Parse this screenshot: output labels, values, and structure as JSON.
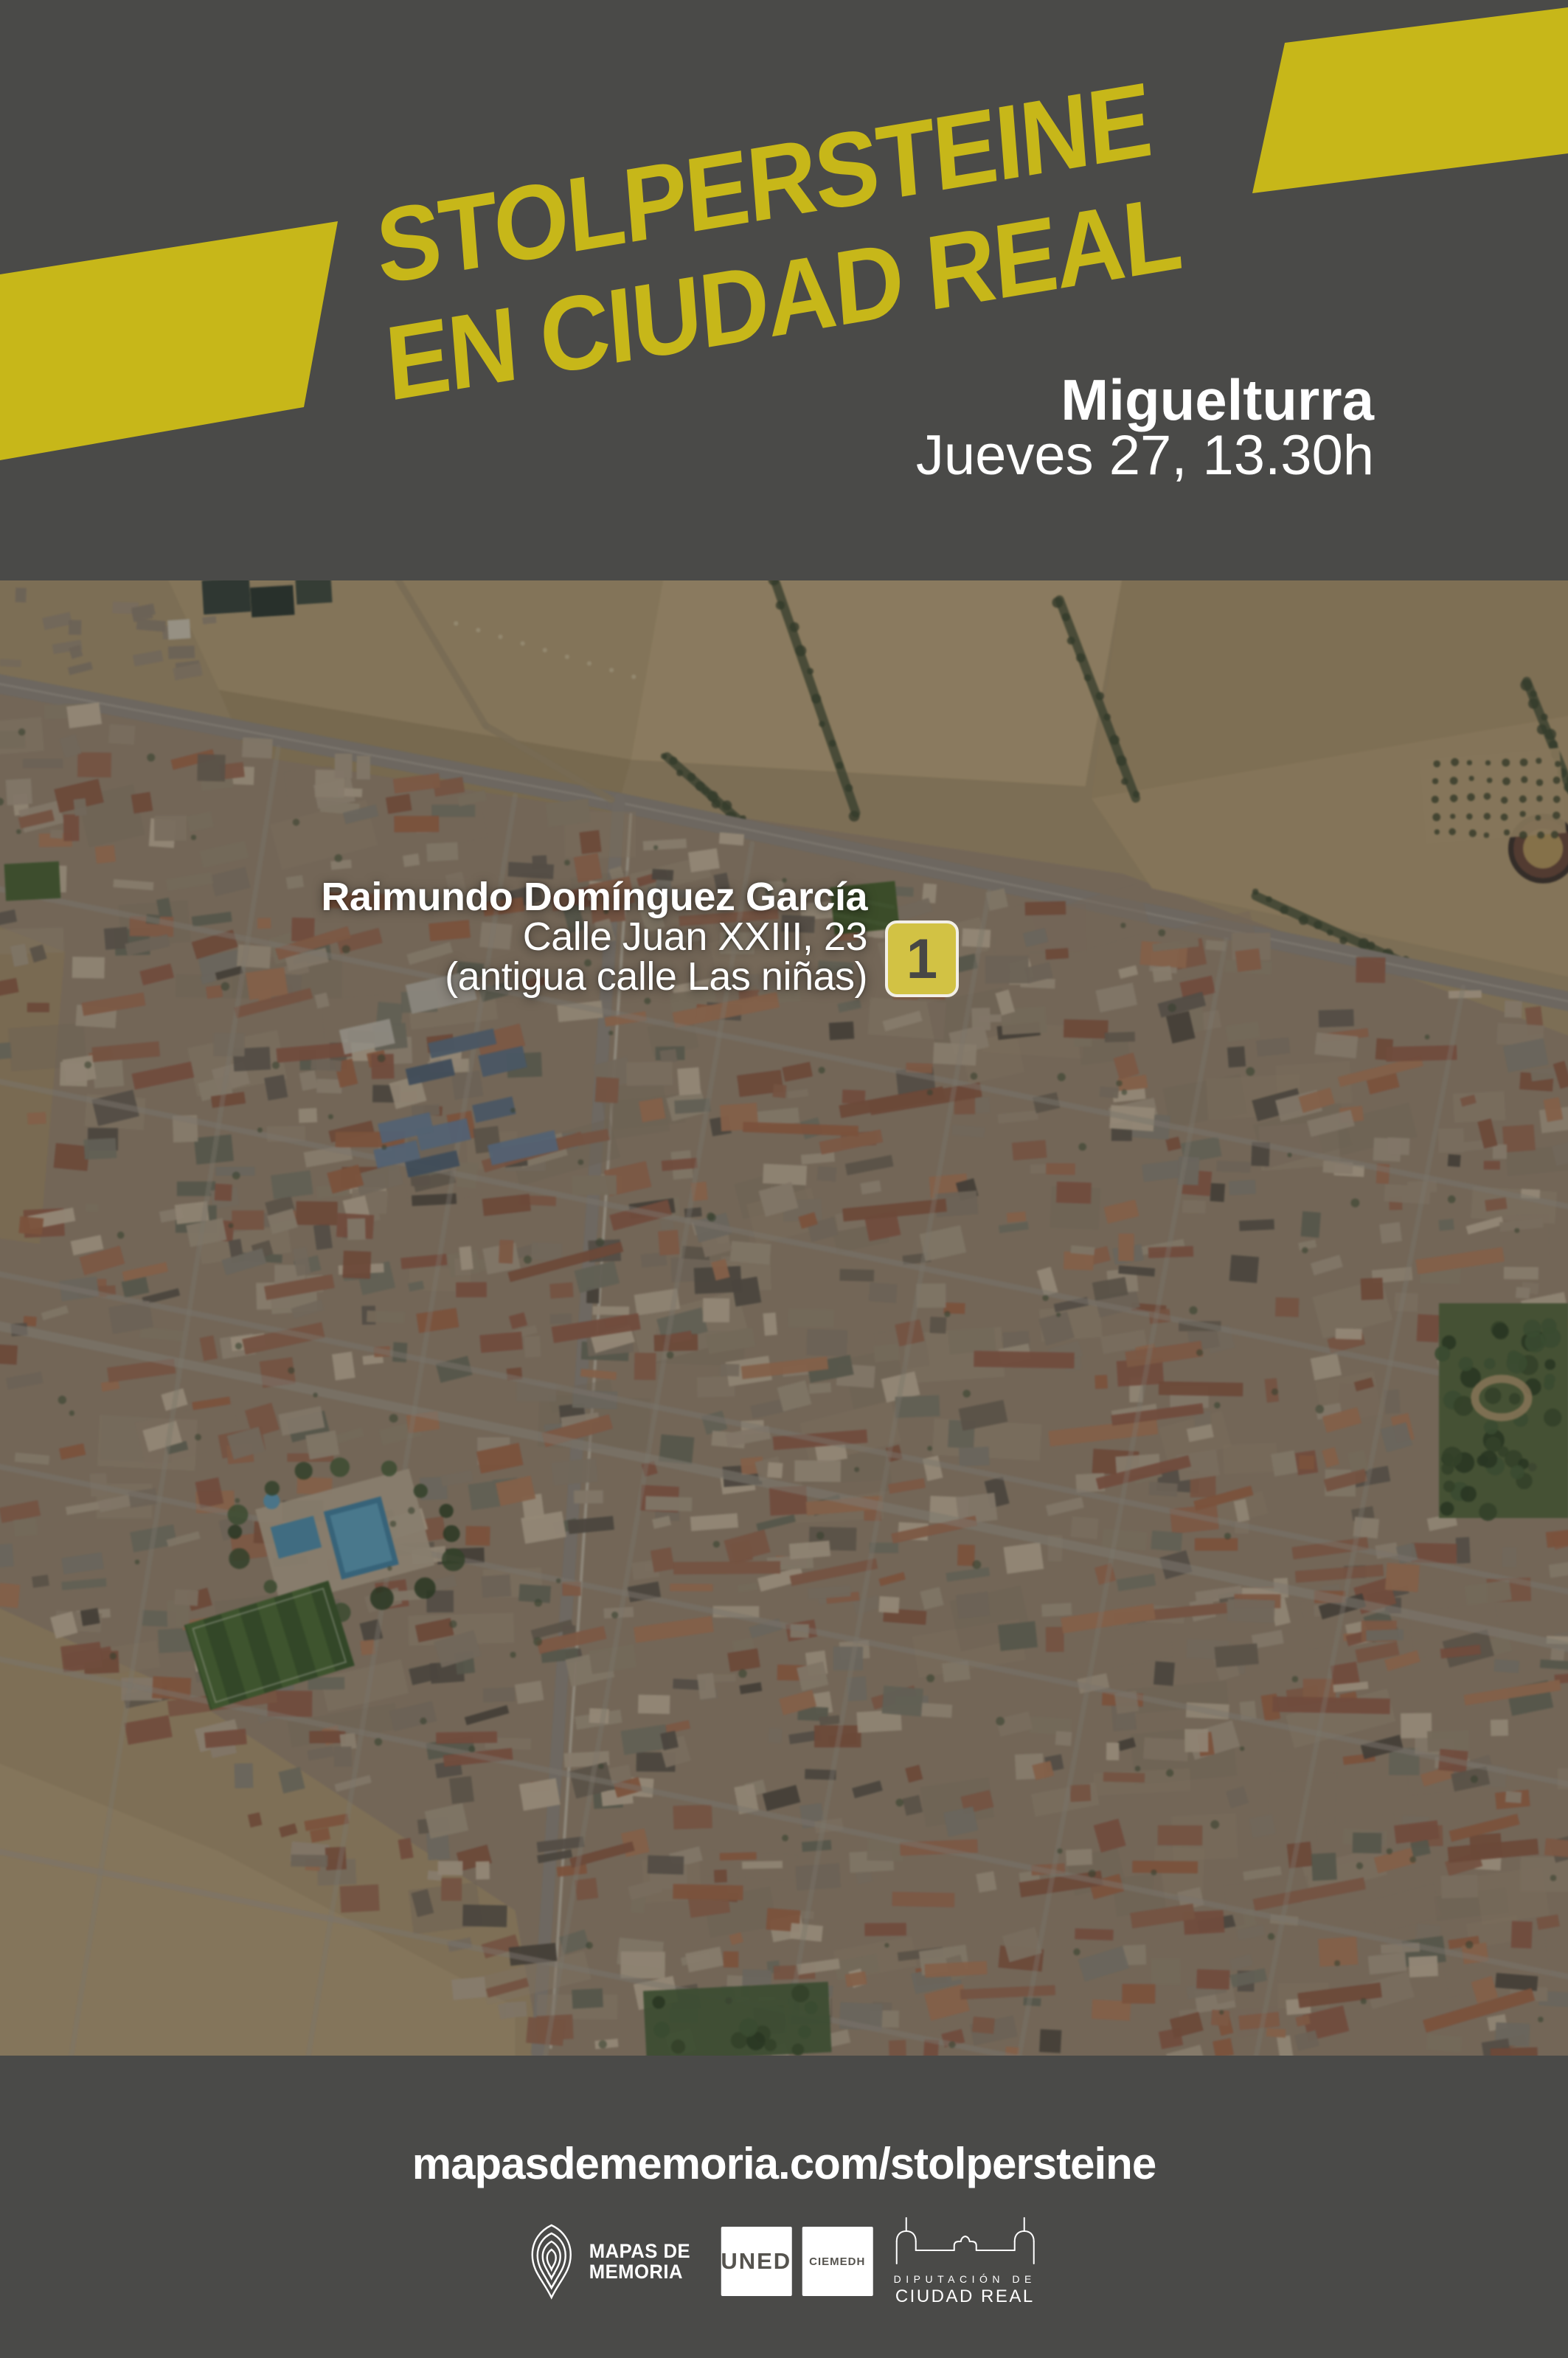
{
  "poster": {
    "title": {
      "line1": "STOLPERSTEINE",
      "line2": "EN CIUDAD REAL"
    },
    "event": {
      "location": "Miguelturra",
      "datetime": "Jueves 27, 13.30h"
    },
    "stolperstein": {
      "marker_number": "1",
      "person_name": "Raimundo Domínguez García",
      "address": "Calle Juan XXIII, 23",
      "address_former": "(antigua calle Las niñas)"
    },
    "footer": {
      "url": "mapasdememoria.com/stolpersteine",
      "logos": {
        "mapas_de_memoria": {
          "line1": "MAPAS DE",
          "line2": "MEMORIA"
        },
        "uned": "UNED",
        "ciemedh": "CIEMEDH",
        "diputacion": {
          "line1": "DIPUTACIÓN DE",
          "line2": "CIUDAD REAL"
        }
      }
    },
    "colors": {
      "background": "#4a4a48",
      "banner_yellow": "#c7b719",
      "badge_yellow": "#d2c244",
      "text_white": "#ffffff",
      "map_palette": {
        "fields": "#a9946f",
        "roofs": "#9b6a51",
        "walls": "#b3a38d",
        "roads": "#8b857c",
        "vegetation": "#46603a",
        "pool_blue": "#4b8fae",
        "arena_sand": "#b3955a"
      }
    }
  }
}
